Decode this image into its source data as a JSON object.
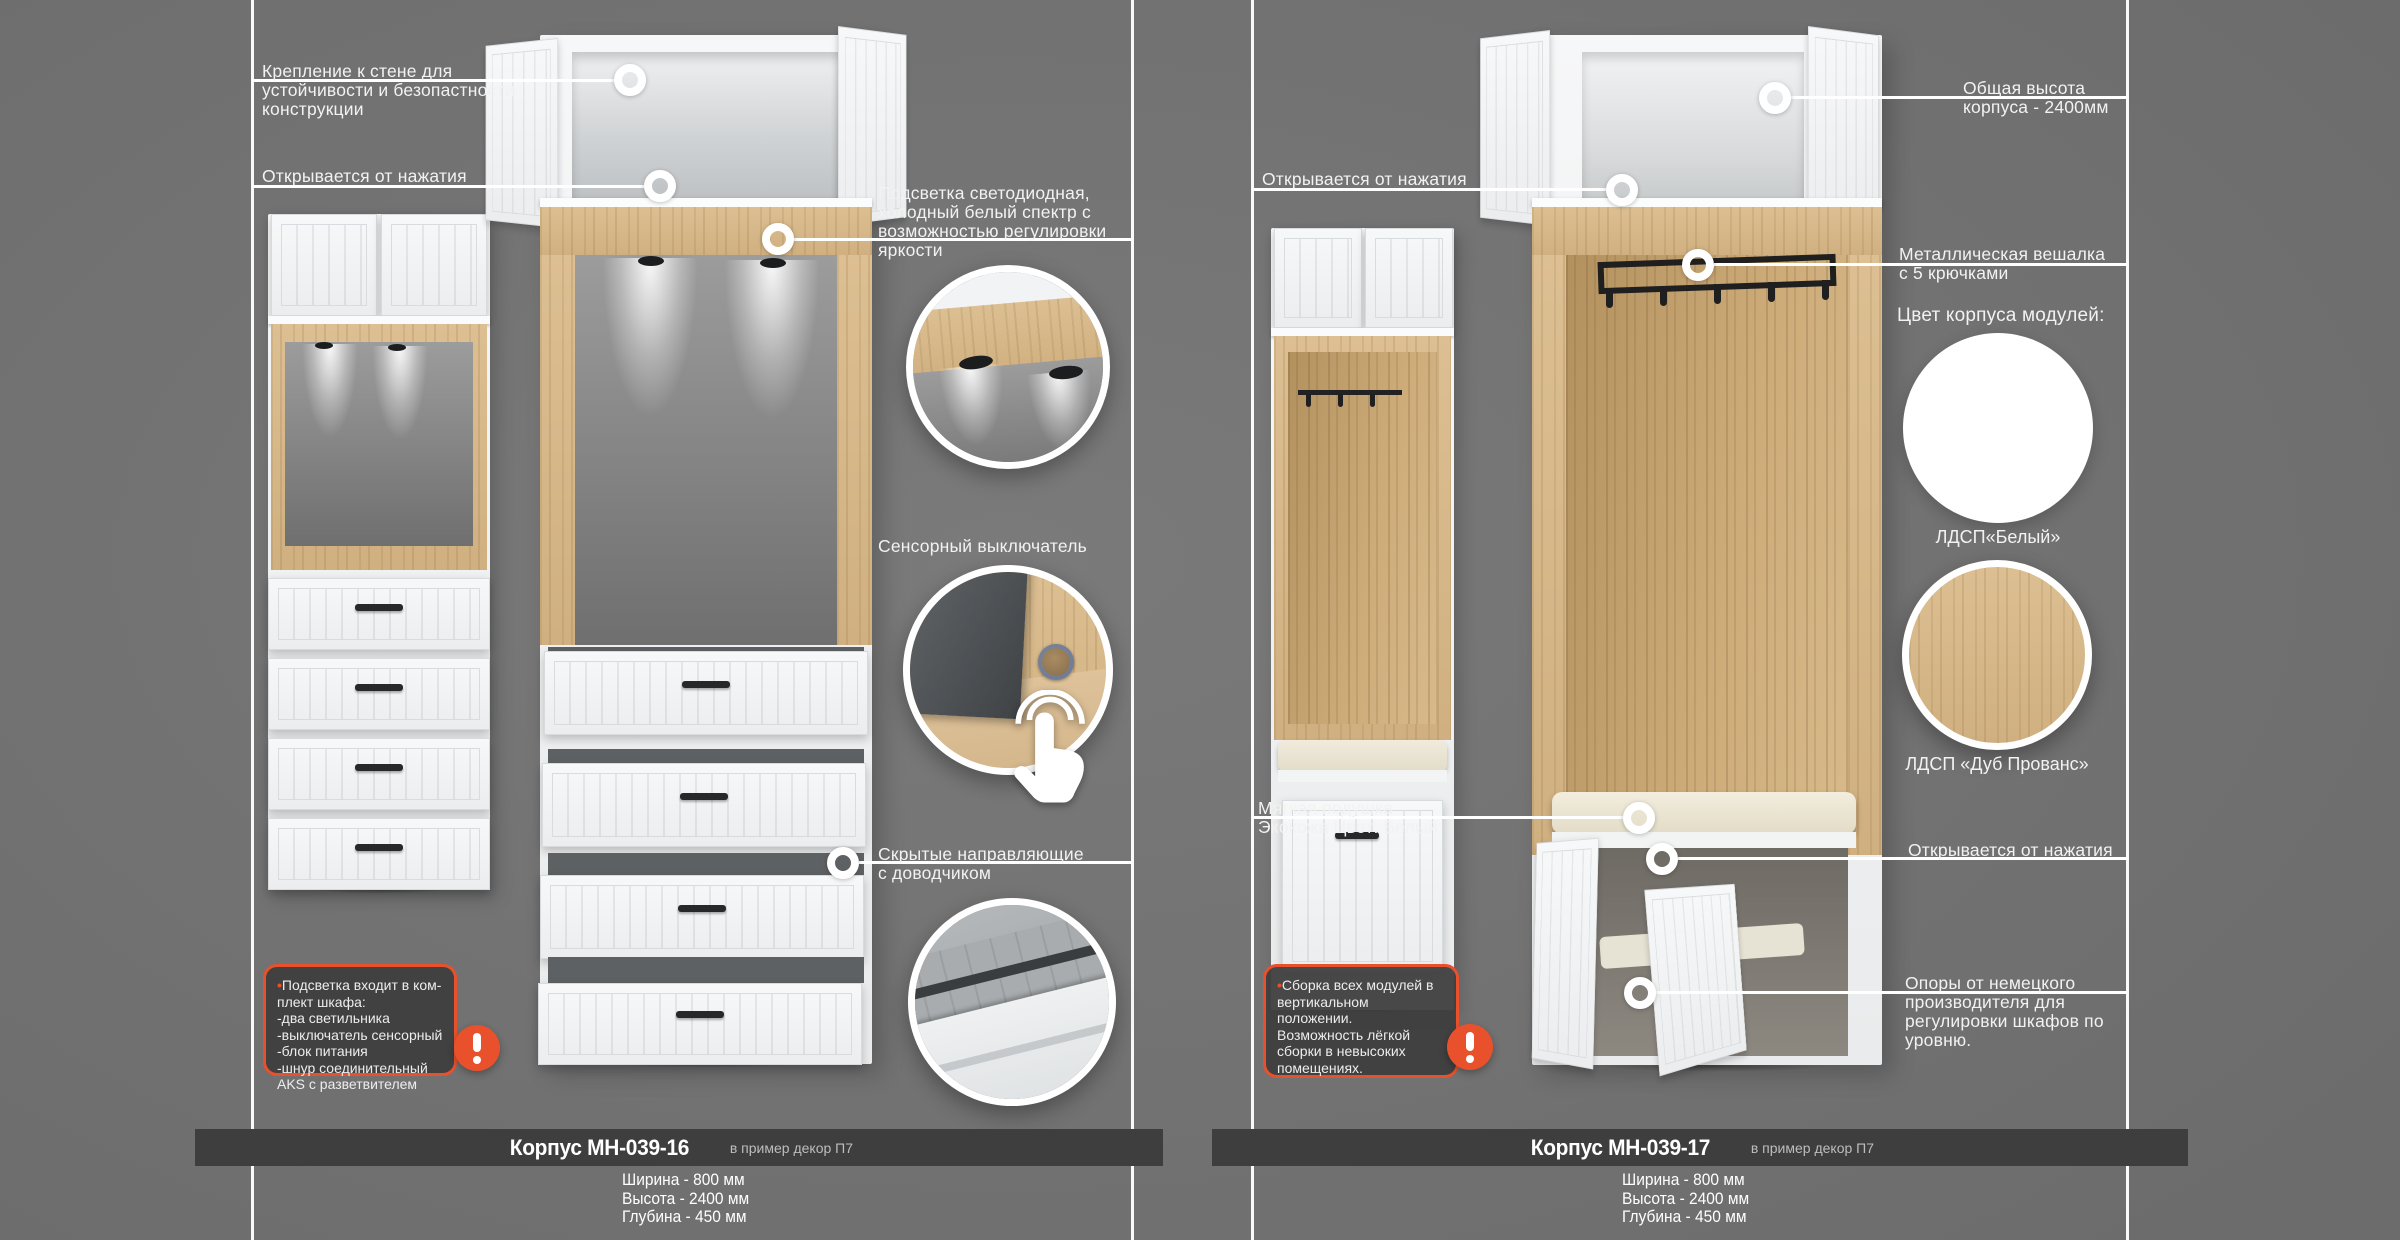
{
  "colors": {
    "background": "#747474",
    "accent_orange": "#e8512c",
    "band": "#3e3e3e",
    "wood": "#d0b080",
    "white_panel": "#f2f3f4"
  },
  "left": {
    "ann_wall_mount": [
      "Крепление к стене для",
      "устойчивости и безопастности",
      "конструкции"
    ],
    "ann_push_open": "Открывается от нажатия",
    "ann_led": [
      "Подсветка светодиодная,",
      "холодный белый спектр с",
      "возможностью регулировки",
      "яркости"
    ],
    "ann_sensor": "Сенсорный выключатель",
    "ann_rails": [
      "Скрытые направляющие",
      "с доводчиком"
    ],
    "note": {
      "bullet": "•",
      "lines": [
        "Подсветка входит в ком-",
        "плект шкафа:",
        "-два светильника",
        "-выключатель  сенсорный",
        "-блок питания",
        "-шнур соединительный",
        "AKS с разветвителем"
      ]
    },
    "footer": {
      "title": "Корпус МН-039-16",
      "suffix": "в пример декор П7",
      "dims": [
        "Ширина - 800 мм",
        "Высота - 2400 мм",
        "Глубина - 450 мм"
      ]
    }
  },
  "right": {
    "ann_push_open_top": "Открывается от нажатия",
    "ann_total_height": [
      "Общая высота",
      "корпуса - 2400мм"
    ],
    "ann_hanger": [
      "Металлическая вешалка",
      "с 5 крючками"
    ],
    "swatches_title": "Цвет корпуса модулей:",
    "swatch_white_label": "ЛДСП«Белый»",
    "swatch_oak_label": "ЛДСП «Дуб Прованс»",
    "ann_cushion": [
      "Мягкая подушка",
      "Экокожа Цвет: Белый"
    ],
    "ann_push_open_bottom": "Открывается от нажатия",
    "ann_feet": [
      "Опоры от немецкого",
      "производителя для",
      "регулировки шкафов по",
      "уровню."
    ],
    "note": {
      "bullet": "•",
      "lines": [
        "Сборка всех модулей в",
        "вертикальном положении.",
        "Возможность лёгкой",
        "сборки в невысоких",
        "помещениях."
      ]
    },
    "footer": {
      "title": "Корпус МН-039-17",
      "suffix": "в пример декор П7",
      "dims": [
        "Ширина - 800 мм",
        "Высота - 2400 мм",
        "Глубина - 450 мм"
      ]
    }
  }
}
